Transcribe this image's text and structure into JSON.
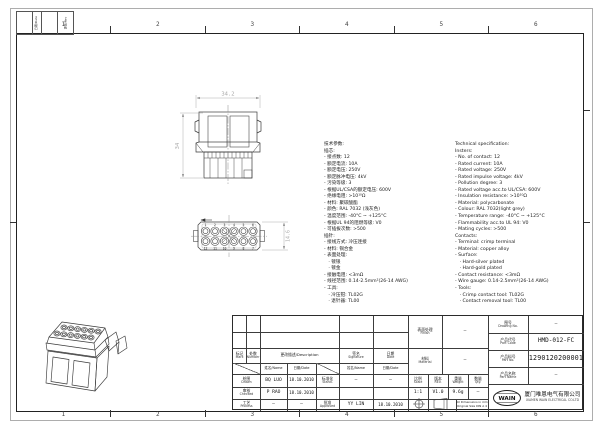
{
  "sheet": {
    "zones": [
      "1",
      "2",
      "3",
      "4",
      "5",
      "6"
    ],
    "corner": {
      "col_a": "日期/Date",
      "col_b": "更改/Rev"
    }
  },
  "views": {
    "side": {
      "dim_width": "34.2",
      "dim_side": "34"
    },
    "front": {
      "dim_height": "14.6",
      "contacts_top": [
        "1",
        "2",
        "3",
        "4",
        "5",
        "6"
      ],
      "contacts_bottom": [
        "12",
        "11",
        "10",
        "9",
        "8",
        "7"
      ]
    }
  },
  "spec_cn": {
    "lines": [
      "技术参数:",
      "插芯:",
      "- 接点数: 12",
      "- 额定电流: 10A",
      "- 额定电压: 250V",
      "- 额定脉冲电压: 4kV",
      "- 污染等级: 3",
      "- 根据UL/CSA的额定电压: 600V",
      "- 绝缘电阻: >10¹⁰Ω",
      "- 材料: 聚碳酸酯",
      "- 颜色: RAL 7032 (浅灰色)",
      "- 温度范围: -40°C ~ +125°C",
      "- 根据UL 94的阻燃等级: V0",
      "- 可插拔次数: >500",
      "插针:",
      "- 接线方式: 冷压连接",
      "- 材料: 铜合金",
      "- 表面处理:",
      "   · 镀银",
      "   · 镀金",
      "- 接触电阻: <3mΩ",
      "- 线径范围: 0.14-2.5mm²(26-14 AWG)",
      "- 工具:",
      "   · 冷压钳: TL02G",
      "   · 退针器: TL00"
    ]
  },
  "spec_en": {
    "lines": [
      "Technical specification:",
      "Insters:",
      "- No. of contact: 12",
      "- Rated current: 10A",
      "- Rated voltage: 250V",
      "- Rated impulse voltage: 4kV",
      "- Pollution degree: 3",
      "- Rated voltage acc.to UL/CSA: 600V",
      "- Insulation resistance: >10¹⁰Ω",
      "- Material: polycarbonate",
      "- Colour: RAL 7032(light grey)",
      "- Temperature range: -40°C ~ +125°C",
      "- Flammability acc.to UL 94: V0",
      "- Mating cycles: >500",
      "Contacts:",
      "- Terminal: crimp terminal",
      "- Material: copper alloy",
      "- Surface:",
      "   · Hard-silver plated",
      "   · Hard-gold plated",
      "- Contact resistance: <3mΩ",
      "- Wire gauge: 0.14-2.5mm²(26-14 AWG)",
      "- Tools:",
      "   · Crimp contact tool: TL02G",
      "   · Contact removal tool: TL00"
    ]
  },
  "titleblock": {
    "mark": {
      "cn": "标记",
      "en": "Mark"
    },
    "number": {
      "cn": "处数",
      "en": "Number"
    },
    "description": "更改描述/Description",
    "signature": {
      "cn": "签名",
      "en": "Signature"
    },
    "date": {
      "cn": "日期",
      "en": "Date"
    },
    "name_date": {
      "name": "姓名/Name",
      "date": "日期/Date"
    },
    "drawn": {
      "cn": "绘图",
      "en": "Drawn",
      "name": "BQ LUO",
      "date": "18.10.2010"
    },
    "checked": {
      "cn": "审核",
      "en": "Checked",
      "name": "P RAO",
      "date": "18.10.2010"
    },
    "process": {
      "cn": "工艺",
      "en": "Process",
      "name": "—",
      "date": "—"
    },
    "standard": {
      "cn": "标准化",
      "en": "Stand.",
      "name": "—",
      "date": "—"
    },
    "approved": {
      "cn": "批准",
      "en": "Approved",
      "name": "YY LIN",
      "date": "18.10.2010"
    },
    "finish": {
      "cn": "表面处理",
      "en": "Finish",
      "value": "—"
    },
    "material": {
      "cn": "材料",
      "en": "Material",
      "value": "—"
    },
    "scale": {
      "cn": "比例",
      "en": "Scale",
      "value": "1:1"
    },
    "rev": {
      "cn": "版本",
      "en": "REV.",
      "value": "V1.0"
    },
    "weight": {
      "cn": "重量",
      "en": "Weight",
      "value": "9.6g"
    },
    "qty": {
      "cn": "数量",
      "en": "Qty.",
      "value": "—"
    },
    "dims_note_1": "All Dimensions in mm",
    "dims_note_2": "Original Size DIN A 4",
    "drawing_no": {
      "cn": "图号",
      "en": "Drawing No.",
      "value": "—"
    },
    "part_code": {
      "cn": "产品代号",
      "en": "Part Code",
      "value": "HMD-012-FC"
    },
    "part_no": {
      "cn": "产品料号",
      "en": "Part No.",
      "value": "1290120200001"
    },
    "part_name": {
      "cn": "产品名称",
      "en": "Part Name",
      "value": "—"
    },
    "company": {
      "logo": "WAIN",
      "cn": "厦门唯恩电气有限公司",
      "en": "XIAMEN WAIN ELECTRICAL CO.LTD"
    }
  }
}
